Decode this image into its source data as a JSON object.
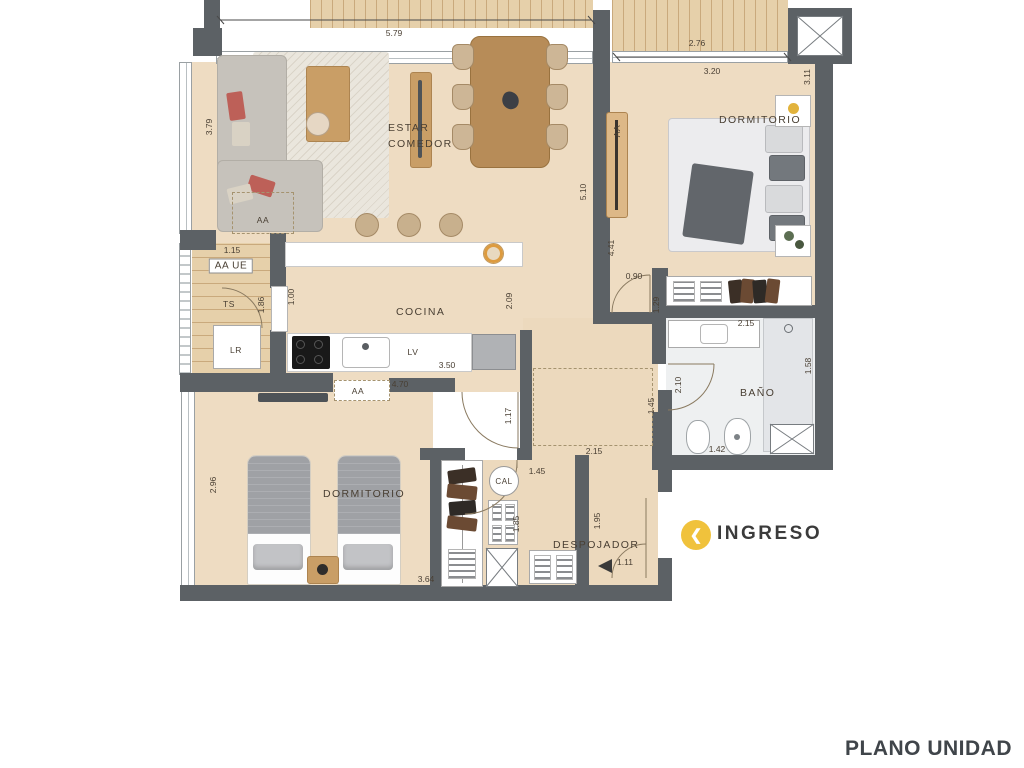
{
  "title": "PLANO UNIDAD",
  "entrance": {
    "label": "INGRESO",
    "icon": "chevron-left-in-yellow-circle",
    "icon_color": "#f0c23c"
  },
  "colors": {
    "wall": "#5c6165",
    "wood_floor": "#eedcc2",
    "deck": "#e6d0aa",
    "accent_yellow": "#f0c23c",
    "label_text": "#493f33",
    "title_text": "#40454a"
  },
  "room_labels": [
    {
      "name": "estar-comedor",
      "lines": [
        "ESTAR",
        "COMEDOR"
      ],
      "x": 388,
      "y": 128
    },
    {
      "name": "dormitorio-principal",
      "lines": [
        "DORMITORIO"
      ],
      "x": 719,
      "y": 112
    },
    {
      "name": "cocina",
      "lines": [
        "COCINA"
      ],
      "x": 396,
      "y": 304
    },
    {
      "name": "bano",
      "lines": [
        "BAÑO"
      ],
      "x": 740,
      "y": 385
    },
    {
      "name": "dormitorio-secundario",
      "lines": [
        "DORMITORIO"
      ],
      "x": 323,
      "y": 486
    },
    {
      "name": "despojador",
      "lines": [
        "DESPOJADOR"
      ],
      "x": 553,
      "y": 537
    }
  ],
  "fixture_labels": [
    {
      "name": "aa-living",
      "text": "AA",
      "x": 263,
      "y": 220
    },
    {
      "name": "aa-ue",
      "text": "AA UE",
      "x": 231,
      "y": 266,
      "boxed": true
    },
    {
      "name": "ts",
      "text": "TS",
      "x": 229,
      "y": 304
    },
    {
      "name": "lr",
      "text": "LR",
      "x": 236,
      "y": 350
    },
    {
      "name": "lv",
      "text": "LV",
      "x": 413,
      "y": 352
    },
    {
      "name": "aa-cocina",
      "text": "AA",
      "x": 358,
      "y": 391
    },
    {
      "name": "aa-dormitorio",
      "text": "AA",
      "x": 617,
      "y": 131,
      "rot": -90
    },
    {
      "name": "cal",
      "text": "CAL",
      "x": 504,
      "y": 481,
      "circled": true
    }
  ],
  "dimensions": [
    {
      "text": "5.79",
      "x": 394,
      "y": 33
    },
    {
      "text": "2.76",
      "x": 697,
      "y": 43
    },
    {
      "text": "3.20",
      "x": 712,
      "y": 71
    },
    {
      "text": "3.11",
      "x": 807,
      "y": 77,
      "rot": -90
    },
    {
      "text": "3.79",
      "x": 209,
      "y": 127,
      "rot": -90
    },
    {
      "text": "5.10",
      "x": 583,
      "y": 192,
      "rot": -90
    },
    {
      "text": "4.41",
      "x": 611,
      "y": 248,
      "rot": -90
    },
    {
      "text": "0.90",
      "x": 634,
      "y": 276
    },
    {
      "text": "1.29",
      "x": 656,
      "y": 305,
      "rot": -90
    },
    {
      "text": "1.15",
      "x": 232,
      "y": 250
    },
    {
      "text": "1.86",
      "x": 261,
      "y": 305,
      "rot": -90
    },
    {
      "text": "1.00",
      "x": 291,
      "y": 297,
      "rot": -90
    },
    {
      "text": "2.09",
      "x": 509,
      "y": 301,
      "rot": -90
    },
    {
      "text": "2.15",
      "x": 746,
      "y": 323
    },
    {
      "text": "1.58",
      "x": 808,
      "y": 366,
      "rot": -90
    },
    {
      "text": "2.10",
      "x": 678,
      "y": 385,
      "rot": -90
    },
    {
      "text": "3.50",
      "x": 447,
      "y": 365
    },
    {
      "text": "4.70",
      "x": 400,
      "y": 384
    },
    {
      "text": "1.17",
      "x": 508,
      "y": 416,
      "rot": -90
    },
    {
      "text": "1.45",
      "x": 651,
      "y": 406,
      "rot": -90
    },
    {
      "text": "1.42",
      "x": 717,
      "y": 449
    },
    {
      "text": "2.15",
      "x": 594,
      "y": 451
    },
    {
      "text": "1.45",
      "x": 537,
      "y": 471
    },
    {
      "text": "2.96",
      "x": 213,
      "y": 485,
      "rot": -90
    },
    {
      "text": "1.85",
      "x": 516,
      "y": 524,
      "rot": -90
    },
    {
      "text": "1.95",
      "x": 597,
      "y": 521,
      "rot": -90
    },
    {
      "text": "1.11",
      "x": 625,
      "y": 562
    },
    {
      "text": "3.64",
      "x": 426,
      "y": 579
    }
  ]
}
